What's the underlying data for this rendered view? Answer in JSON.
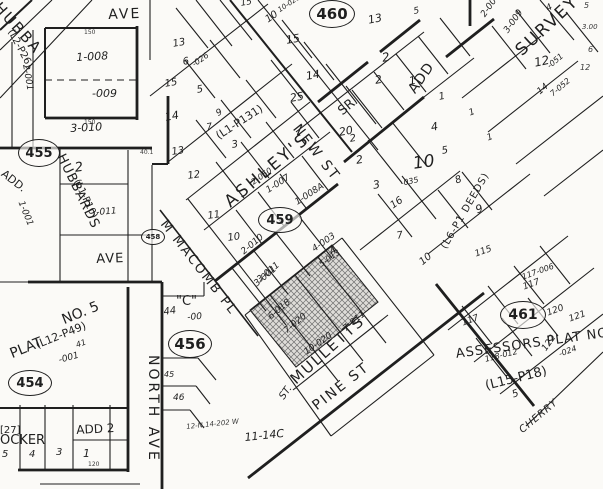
{
  "colors": {
    "paper": "#fbfaf7",
    "ink": "#1f1f1f",
    "shaded_parcel_fill": "#d8d6d2",
    "hatch_line": "#6f6f6f"
  },
  "labels": [
    {
      "n": "street-ave-top",
      "t": "AVE",
      "x": 108,
      "y": 8,
      "r": -2,
      "s": 14,
      "ls": 2
    },
    {
      "n": "street-ave-mid",
      "t": "AVE",
      "x": 96,
      "y": 253,
      "r": -2,
      "s": 13,
      "ls": 1
    },
    {
      "n": "street-north-ave",
      "t": "NORTH AVE",
      "x": 160,
      "y": 355,
      "r": 90,
      "s": 14,
      "ls": 3
    },
    {
      "n": "street-m-macomb-pl",
      "t": "M MACOMB PL",
      "x": 168,
      "y": 218,
      "r": 52,
      "s": 13,
      "ls": 2
    },
    {
      "n": "street-new-st",
      "t": "NEW ST",
      "x": 301,
      "y": 122,
      "r": 52,
      "s": 14,
      "ls": 2
    },
    {
      "n": "street-pine-st",
      "t": "PINE ST",
      "x": 310,
      "y": 402,
      "r": -38,
      "s": 14,
      "ls": 2
    },
    {
      "n": "street-cherry",
      "t": "CHERRY",
      "x": 518,
      "y": 428,
      "r": -40,
      "s": 10,
      "ls": 1,
      "cls": "hand"
    },
    {
      "n": "street-st-fragment",
      "t": "ST.",
      "x": 278,
      "y": 396,
      "r": -55,
      "s": 10,
      "cls": "hand"
    },
    {
      "n": "label-quoted-c",
      "t": "\"C\"",
      "x": 176,
      "y": 295,
      "r": 0,
      "s": 13
    },
    {
      "n": "label-44",
      "t": "44",
      "x": 163,
      "y": 308,
      "r": -8,
      "s": 10,
      "cls": "hand"
    },
    {
      "n": "label-minus00",
      "t": "-00",
      "x": 187,
      "y": 314,
      "r": -5,
      "s": 9,
      "cls": "hand"
    },
    {
      "n": "addition-hubbard",
      "t": "HUBBA",
      "x": 2,
      "y": 0,
      "r": 48,
      "s": 15,
      "ls": 2
    },
    {
      "n": "addition-l2-p26",
      "t": "(L2-P26)",
      "x": 14,
      "y": 28,
      "r": 62,
      "s": 10
    },
    {
      "n": "addition-add-left",
      "t": "ADD.",
      "x": 6,
      "y": 168,
      "r": 38,
      "s": 11
    },
    {
      "n": "addition-hubbards",
      "t": "HUBBARDS",
      "x": 66,
      "y": 152,
      "r": 64,
      "s": 13,
      "ls": 1
    },
    {
      "n": "addition-l1-p10",
      "t": "(L1-P10)",
      "x": 80,
      "y": 178,
      "r": 64,
      "s": 10
    },
    {
      "n": "addition-ashleys",
      "t": "ASHLEY'S",
      "x": 222,
      "y": 198,
      "r": -40,
      "s": 17,
      "ls": 3
    },
    {
      "n": "addition-l1-p131",
      "t": "(L1-P131)",
      "x": 214,
      "y": 132,
      "r": -33,
      "s": 11
    },
    {
      "n": "addition-sr",
      "t": "SR.",
      "x": 336,
      "y": 108,
      "r": -40,
      "s": 13
    },
    {
      "n": "addition-add-right",
      "t": "ADD",
      "x": 406,
      "y": 88,
      "r": -55,
      "s": 14,
      "ls": 1
    },
    {
      "n": "addition-survey",
      "t": "SURVEY",
      "x": 513,
      "y": 47,
      "r": -43,
      "s": 17,
      "ls": 2
    },
    {
      "n": "addition-mulletts",
      "t": "MULLETTS",
      "x": 288,
      "y": 376,
      "r": -42,
      "s": 15,
      "ls": 2
    },
    {
      "n": "addition-plat",
      "t": "PLAT",
      "x": 8,
      "y": 348,
      "r": -22,
      "s": 14
    },
    {
      "n": "addition-no-5",
      "t": "NO. 5",
      "x": 60,
      "y": 314,
      "r": -22,
      "s": 14
    },
    {
      "n": "addition-l12-p49",
      "t": "(L12-P49)",
      "x": 34,
      "y": 340,
      "r": -22,
      "s": 11
    },
    {
      "n": "parcel-001-plat5",
      "t": "-001",
      "x": 58,
      "y": 357,
      "r": -15,
      "s": 9,
      "cls": "hand"
    },
    {
      "n": "addition-27",
      "t": "[27]",
      "x": 0,
      "y": 426,
      "r": 0,
      "s": 10
    },
    {
      "n": "addition-ocker",
      "t": "OCKER",
      "x": 0,
      "y": 434,
      "r": 0,
      "s": 13
    },
    {
      "n": "addition-add-2",
      "t": "ADD 2",
      "x": 76,
      "y": 424,
      "r": -3,
      "s": 12
    },
    {
      "n": "addition-assessors-plat",
      "t": "ASSESSORS PLAT NO.",
      "x": 455,
      "y": 348,
      "r": -8,
      "s": 13,
      "ls": 1
    },
    {
      "n": "addition-l15-p18",
      "t": "(L15-P18)",
      "x": 484,
      "y": 380,
      "r": -14,
      "s": 13
    },
    {
      "n": "addition-l6-p1-deeds",
      "t": "(L6-P1 DEEDS)",
      "x": 440,
      "y": 246,
      "r": -60,
      "s": 10,
      "ls": 1
    },
    {
      "n": "note-11-14c",
      "t": "11-14C",
      "x": 244,
      "y": 432,
      "r": -6,
      "s": 11,
      "cls": "hand"
    },
    {
      "n": "note-scribble",
      "t": "12-N.14-202 W",
      "x": 186,
      "y": 424,
      "r": -6,
      "s": 7,
      "cls": "hand dim"
    },
    {
      "n": "parcel-1-008",
      "t": "1-008",
      "x": 76,
      "y": 52,
      "r": -3,
      "s": 11,
      "cls": "hand"
    },
    {
      "n": "parcel-009",
      "t": "-009",
      "x": 92,
      "y": 88,
      "r": 0,
      "s": 11,
      "cls": "hand"
    },
    {
      "n": "parcel-3-010",
      "t": "3-010",
      "x": 70,
      "y": 123,
      "r": -3,
      "s": 11,
      "cls": "hand"
    },
    {
      "n": "parcel-2-001",
      "t": "2-001",
      "x": 29,
      "y": 64,
      "r": 80,
      "s": 9,
      "cls": "hand"
    },
    {
      "n": "parcel-1-001",
      "t": "1-001",
      "x": 24,
      "y": 200,
      "r": 68,
      "s": 9,
      "cls": "hand"
    },
    {
      "n": "parcel-011",
      "t": "-011",
      "x": 96,
      "y": 209,
      "r": -5,
      "s": 9,
      "cls": "hand"
    },
    {
      "n": "lot-2-hubbards",
      "t": "2",
      "x": 74,
      "y": 162,
      "r": -8,
      "s": 13,
      "cls": "hand"
    },
    {
      "n": "lot-13-upper",
      "t": "13",
      "x": 172,
      "y": 40,
      "r": -10,
      "s": 10,
      "cls": "hand"
    },
    {
      "n": "lot-15-ashley",
      "t": "15",
      "x": 164,
      "y": 80,
      "r": -10,
      "s": 10,
      "cls": "hand"
    },
    {
      "n": "lot-14-ashley",
      "t": "14",
      "x": 164,
      "y": 112,
      "r": -10,
      "s": 11,
      "cls": "hand"
    },
    {
      "n": "lot-6-ashley",
      "t": "6",
      "x": 182,
      "y": 58,
      "r": -10,
      "s": 10,
      "cls": "hand"
    },
    {
      "n": "parcel-026",
      "t": "-026",
      "x": 191,
      "y": 62,
      "r": -35,
      "s": 8,
      "cls": "hand"
    },
    {
      "n": "lot-5-ashley",
      "t": "5",
      "x": 196,
      "y": 86,
      "r": -10,
      "s": 10,
      "cls": "hand"
    },
    {
      "n": "lot-9-ashley",
      "t": "9",
      "x": 215,
      "y": 111,
      "r": -30,
      "s": 9,
      "cls": "hand"
    },
    {
      "n": "lot-7-ashley",
      "t": "7",
      "x": 206,
      "y": 124,
      "r": -10,
      "s": 9,
      "cls": "hand"
    },
    {
      "n": "lot-3-ashley",
      "t": "3",
      "x": 231,
      "y": 141,
      "r": -10,
      "s": 10,
      "cls": "hand"
    },
    {
      "n": "lot-13-macomb",
      "t": "13",
      "x": 171,
      "y": 148,
      "r": -8,
      "s": 10,
      "cls": "hand"
    },
    {
      "n": "lot-12-macomb",
      "t": "12",
      "x": 187,
      "y": 172,
      "r": -8,
      "s": 10,
      "cls": "hand"
    },
    {
      "n": "lot-11-macomb",
      "t": "11",
      "x": 207,
      "y": 212,
      "r": -8,
      "s": 10,
      "cls": "hand"
    },
    {
      "n": "lot-10-macomb",
      "t": "10",
      "x": 227,
      "y": 234,
      "r": -8,
      "s": 10,
      "cls": "hand"
    },
    {
      "n": "parcel-2-050",
      "t": "2-050",
      "x": 250,
      "y": 180,
      "r": -35,
      "s": 8,
      "cls": "hand"
    },
    {
      "n": "parcel-1-007",
      "t": "1-007",
      "x": 265,
      "y": 188,
      "r": -33,
      "s": 9,
      "cls": "hand"
    },
    {
      "n": "parcel-1-008a",
      "t": "1-008A",
      "x": 294,
      "y": 200,
      "r": -33,
      "s": 9,
      "cls": "hand"
    },
    {
      "n": "parcel-4-003",
      "t": "4-003",
      "x": 311,
      "y": 247,
      "r": -35,
      "s": 9,
      "cls": "hand"
    },
    {
      "n": "parcel-2-010",
      "t": "2-010",
      "x": 240,
      "y": 250,
      "r": -40,
      "s": 9,
      "cls": "hand"
    },
    {
      "n": "parcel-3-011",
      "t": "3-011",
      "x": 256,
      "y": 278,
      "r": -40,
      "s": 9,
      "cls": "hand"
    },
    {
      "n": "lot-15-newst",
      "t": "15",
      "x": 285,
      "y": 35,
      "r": -10,
      "s": 11,
      "cls": "hand"
    },
    {
      "n": "lot-10-newst",
      "t": "10",
      "x": 264,
      "y": 17,
      "r": -35,
      "s": 10,
      "cls": "hand"
    },
    {
      "n": "parcel-10-020-top",
      "t": "10-020",
      "x": 277,
      "y": 8,
      "r": -33,
      "s": 7,
      "cls": "hand"
    },
    {
      "n": "lot-14-newst",
      "t": "14",
      "x": 305,
      "y": 71,
      "r": -10,
      "s": 11,
      "cls": "hand"
    },
    {
      "n": "lot-25-newst",
      "t": "25",
      "x": 289,
      "y": 93,
      "r": -10,
      "s": 11,
      "cls": "hand"
    },
    {
      "n": "lot-20-newst",
      "t": "20",
      "x": 338,
      "y": 127,
      "r": -10,
      "s": 11,
      "cls": "hand"
    },
    {
      "n": "lot-15-topedge",
      "t": "15",
      "x": 240,
      "y": 0,
      "r": -10,
      "s": 9,
      "cls": "hand"
    },
    {
      "n": "lot-13-sradd",
      "t": "13",
      "x": 367,
      "y": 15,
      "r": -12,
      "s": 11,
      "cls": "hand"
    },
    {
      "n": "lot-2-sradd-a",
      "t": "2",
      "x": 381,
      "y": 52,
      "r": -10,
      "s": 12,
      "cls": "hand"
    },
    {
      "n": "lot-2-sradd-b",
      "t": "2",
      "x": 374,
      "y": 75,
      "r": -10,
      "s": 11,
      "cls": "hand"
    },
    {
      "n": "lot-1-sradd-a",
      "t": "1",
      "x": 408,
      "y": 76,
      "r": -10,
      "s": 11,
      "cls": "hand"
    },
    {
      "n": "lot-1-sradd-b",
      "t": "1",
      "x": 438,
      "y": 93,
      "r": -10,
      "s": 10,
      "cls": "hand"
    },
    {
      "n": "lot-5-top",
      "t": "5",
      "x": 413,
      "y": 8,
      "r": -10,
      "s": 9,
      "cls": "hand"
    },
    {
      "n": "parcel-2-008",
      "t": "2-008",
      "x": 480,
      "y": 14,
      "r": -55,
      "s": 9,
      "cls": "hand"
    },
    {
      "n": "parcel-3-009",
      "t": "3-009",
      "x": 503,
      "y": 30,
      "r": -55,
      "s": 9,
      "cls": "hand"
    },
    {
      "n": "lot-12-survey",
      "t": "12",
      "x": 533,
      "y": 57,
      "r": -12,
      "s": 12,
      "cls": "hand"
    },
    {
      "n": "parcel-051",
      "t": "-051",
      "x": 546,
      "y": 64,
      "r": -40,
      "s": 8,
      "cls": "hand"
    },
    {
      "n": "lot-14-survey",
      "t": "14",
      "x": 536,
      "y": 90,
      "r": -40,
      "s": 9,
      "cls": "hand"
    },
    {
      "n": "parcel-7-052",
      "t": "7-052",
      "x": 549,
      "y": 92,
      "r": -40,
      "s": 8,
      "cls": "hand"
    },
    {
      "n": "lot-4-survey",
      "t": "4",
      "x": 545,
      "y": 6,
      "r": -30,
      "s": 9,
      "cls": "hand"
    },
    {
      "n": "dim-5-edge",
      "t": "5",
      "x": 584,
      "y": 2,
      "r": 0,
      "s": 8,
      "cls": "hand dim"
    },
    {
      "n": "dim-300-edge",
      "t": "3.00",
      "x": 582,
      "y": 24,
      "r": 0,
      "s": 7,
      "cls": "hand dim"
    },
    {
      "n": "dim-6-edge",
      "t": "6",
      "x": 588,
      "y": 46,
      "r": 0,
      "s": 8,
      "cls": "hand dim"
    },
    {
      "n": "dim-12-edge",
      "t": "12",
      "x": 580,
      "y": 64,
      "r": 0,
      "s": 8,
      "cls": "hand dim"
    },
    {
      "n": "lot-4-mid",
      "t": "4",
      "x": 430,
      "y": 122,
      "r": -10,
      "s": 11,
      "cls": "hand"
    },
    {
      "n": "lot-5-mid",
      "t": "5",
      "x": 441,
      "y": 147,
      "r": -10,
      "s": 10,
      "cls": "hand"
    },
    {
      "n": "lot-10-big",
      "t": "10",
      "x": 412,
      "y": 156,
      "r": -8,
      "s": 17,
      "cls": "hand"
    },
    {
      "n": "parcel-035",
      "t": "-035",
      "x": 400,
      "y": 180,
      "r": -12,
      "s": 8,
      "cls": "hand"
    },
    {
      "n": "lot-16-mid",
      "t": "16",
      "x": 389,
      "y": 203,
      "r": -35,
      "s": 10,
      "cls": "hand"
    },
    {
      "n": "lot-3-mid",
      "t": "3",
      "x": 372,
      "y": 180,
      "r": -10,
      "s": 11,
      "cls": "hand"
    },
    {
      "n": "lot-2-mid-a",
      "t": "2",
      "x": 355,
      "y": 155,
      "r": -10,
      "s": 11,
      "cls": "hand"
    },
    {
      "n": "lot-2-mid-b",
      "t": "2",
      "x": 349,
      "y": 135,
      "r": -10,
      "s": 10,
      "cls": "hand"
    },
    {
      "n": "lot-7-mid",
      "t": "7",
      "x": 396,
      "y": 232,
      "r": -10,
      "s": 10,
      "cls": "hand"
    },
    {
      "n": "lot-10-mid",
      "t": "10",
      "x": 418,
      "y": 260,
      "r": -40,
      "s": 10,
      "cls": "hand"
    },
    {
      "n": "lot-8-deeds",
      "t": "8",
      "x": 454,
      "y": 177,
      "r": -20,
      "s": 10,
      "cls": "hand"
    },
    {
      "n": "lot-9-deeds",
      "t": "9",
      "x": 474,
      "y": 205,
      "r": -20,
      "s": 11,
      "cls": "hand"
    },
    {
      "n": "lot-1-deeds-a",
      "t": "1",
      "x": 486,
      "y": 135,
      "r": -20,
      "s": 9,
      "cls": "hand"
    },
    {
      "n": "lot-1-deeds-b",
      "t": "1",
      "x": 468,
      "y": 110,
      "r": -20,
      "s": 9,
      "cls": "hand"
    },
    {
      "n": "parcel-3-001",
      "t": "3-001",
      "x": 253,
      "y": 282,
      "r": -40,
      "s": 9,
      "cls": "hand"
    },
    {
      "n": "lot-4-mullett",
      "t": "4",
      "x": 328,
      "y": 249,
      "r": -35,
      "s": 10,
      "cls": "hand"
    },
    {
      "n": "parcel-5-013",
      "t": "5-013",
      "x": 318,
      "y": 262,
      "r": -35,
      "s": 8,
      "cls": "hand"
    },
    {
      "n": "parcel-6-018",
      "t": "6-018",
      "x": 267,
      "y": 315,
      "r": -40,
      "s": 9,
      "cls": "hand"
    },
    {
      "n": "parcel-7-020",
      "t": "7-020",
      "x": 283,
      "y": 329,
      "r": -40,
      "s": 9,
      "cls": "hand"
    },
    {
      "n": "parcel-10-020",
      "t": "10-020",
      "x": 303,
      "y": 350,
      "r": -35,
      "s": 9,
      "cls": "hand"
    },
    {
      "n": "parcel-7-011",
      "t": "7-011",
      "x": 342,
      "y": 327,
      "r": -40,
      "s": 9,
      "cls": "hand"
    },
    {
      "n": "lot-45",
      "t": "45",
      "x": 164,
      "y": 371,
      "r": 0,
      "s": 8,
      "cls": "hand"
    },
    {
      "n": "lot-46",
      "t": "46",
      "x": 173,
      "y": 394,
      "r": 0,
      "s": 9,
      "cls": "hand"
    },
    {
      "n": "lot-41",
      "t": "41",
      "x": 75,
      "y": 342,
      "r": -20,
      "s": 8,
      "cls": "hand"
    },
    {
      "n": "lot-117-a",
      "t": "117",
      "x": 461,
      "y": 320,
      "r": -20,
      "s": 9,
      "cls": "hand"
    },
    {
      "n": "lot-117-b",
      "t": "117",
      "x": 522,
      "y": 284,
      "r": -20,
      "s": 9,
      "cls": "hand"
    },
    {
      "n": "lot-120",
      "t": "120",
      "x": 546,
      "y": 310,
      "r": -20,
      "s": 9,
      "cls": "hand"
    },
    {
      "n": "lot-121",
      "t": "121",
      "x": 568,
      "y": 316,
      "r": -20,
      "s": 9,
      "cls": "hand"
    },
    {
      "n": "lot-122",
      "t": "122",
      "x": 541,
      "y": 348,
      "r": -55,
      "s": 9,
      "cls": "hand"
    },
    {
      "n": "parcel-024",
      "t": "-024",
      "x": 558,
      "y": 351,
      "r": -20,
      "s": 8,
      "cls": "hand"
    },
    {
      "n": "parcel-118-012",
      "t": "118-012",
      "x": 484,
      "y": 356,
      "r": -14,
      "s": 8,
      "cls": "hand"
    },
    {
      "n": "lot-5-assessors",
      "t": "5",
      "x": 511,
      "y": 391,
      "r": -20,
      "s": 10,
      "cls": "hand"
    },
    {
      "n": "lot-115",
      "t": "115",
      "x": 474,
      "y": 251,
      "r": -20,
      "s": 9,
      "cls": "hand"
    },
    {
      "n": "parcel-117-006",
      "t": "117-006",
      "x": 521,
      "y": 274,
      "r": -20,
      "s": 8,
      "cls": "hand"
    },
    {
      "n": "lot-5-ocker",
      "t": "5",
      "x": 2,
      "y": 450,
      "r": 0,
      "s": 10,
      "cls": "hand"
    },
    {
      "n": "lot-4-ocker",
      "t": "4",
      "x": 29,
      "y": 450,
      "r": 0,
      "s": 10,
      "cls": "hand"
    },
    {
      "n": "lot-3-ocker",
      "t": "3",
      "x": 56,
      "y": 448,
      "r": 0,
      "s": 10,
      "cls": "hand"
    },
    {
      "n": "lot-1-ocker",
      "t": "1",
      "x": 83,
      "y": 448,
      "r": 0,
      "s": 11,
      "cls": "hand"
    },
    {
      "n": "dim-150-a",
      "t": "150",
      "x": 84,
      "y": 30,
      "r": 0,
      "s": 6,
      "cls": "dim"
    },
    {
      "n": "dim-150-b",
      "t": "150",
      "x": 84,
      "y": 120,
      "r": 0,
      "s": 6,
      "cls": "dim"
    },
    {
      "n": "dim-40-1",
      "t": "40.1",
      "x": 140,
      "y": 150,
      "r": 0,
      "s": 6,
      "cls": "dim"
    },
    {
      "n": "dim-120",
      "t": "120",
      "x": 88,
      "y": 462,
      "r": 0,
      "s": 6,
      "cls": "dim"
    }
  ],
  "circles": [
    {
      "n": "sheet-455",
      "t": "455",
      "x": 38,
      "y": 152,
      "rx": 20,
      "ry": 13,
      "s": 13
    },
    {
      "n": "sheet-458",
      "t": "458",
      "x": 152,
      "y": 236,
      "rx": 11,
      "ry": 7,
      "s": 7
    },
    {
      "n": "sheet-459",
      "t": "459",
      "x": 279,
      "y": 219,
      "rx": 21,
      "ry": 12,
      "s": 13
    },
    {
      "n": "sheet-460",
      "t": "460",
      "x": 331,
      "y": 13,
      "rx": 22,
      "ry": 13,
      "s": 15
    },
    {
      "n": "sheet-454",
      "t": "454",
      "x": 29,
      "y": 382,
      "rx": 21,
      "ry": 12,
      "s": 13
    },
    {
      "n": "sheet-456",
      "t": "456",
      "x": 189,
      "y": 343,
      "rx": 21,
      "ry": 13,
      "s": 15
    },
    {
      "n": "sheet-461",
      "t": "461",
      "x": 522,
      "y": 314,
      "rx": 22,
      "ry": 13,
      "s": 14
    }
  ]
}
